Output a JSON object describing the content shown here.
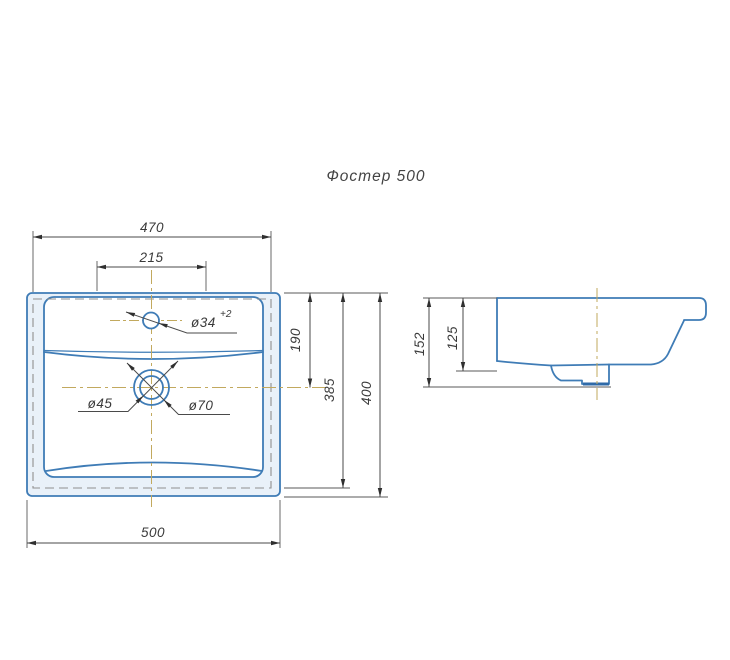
{
  "title": "Фостер 500",
  "colors": {
    "sink_outline": "#3f7cb6",
    "dimension_lines": "#4a4a4a",
    "hidden_lines": "#8f8f8f",
    "centerlines": "#c2a95e",
    "rim_band_fill": "#e9f1f9",
    "background": "#ffffff"
  },
  "top_view": {
    "dimensions": {
      "top_width": "470",
      "tap_span": "215",
      "bottom_width": "500",
      "drain_offset": "190",
      "inner_depth": "385",
      "total_depth": "400",
      "tap_hole_diameter": "ø34",
      "tap_hole_tolerance": "+2",
      "drain_inner_diameter": "ø45",
      "drain_outer_diameter": "ø70"
    }
  },
  "side_view": {
    "dimensions": {
      "total_height": "152",
      "bowl_height": "125"
    }
  }
}
